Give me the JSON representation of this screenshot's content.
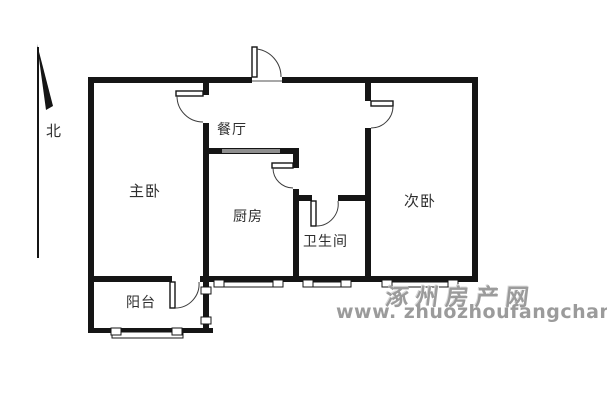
{
  "compass": {
    "label": "北"
  },
  "rooms": [
    {
      "id": "master-bedroom",
      "label": "主卧"
    },
    {
      "id": "dining-room",
      "label": "餐厅"
    },
    {
      "id": "kitchen",
      "label": "厨房"
    },
    {
      "id": "bathroom",
      "label": "卫生间"
    },
    {
      "id": "second-bedroom",
      "label": "次卧"
    },
    {
      "id": "balcony",
      "label": "阳台"
    }
  ],
  "watermark": {
    "site_name": "涿州房产网",
    "url": "www. zhuozhoufangchan. com"
  },
  "colors": {
    "wall": "#151515",
    "window_gray": "#8f8f8f",
    "watermark_gray": "#9b9b9b",
    "background": "#ffffff",
    "label_text": "#2e2e2e"
  }
}
